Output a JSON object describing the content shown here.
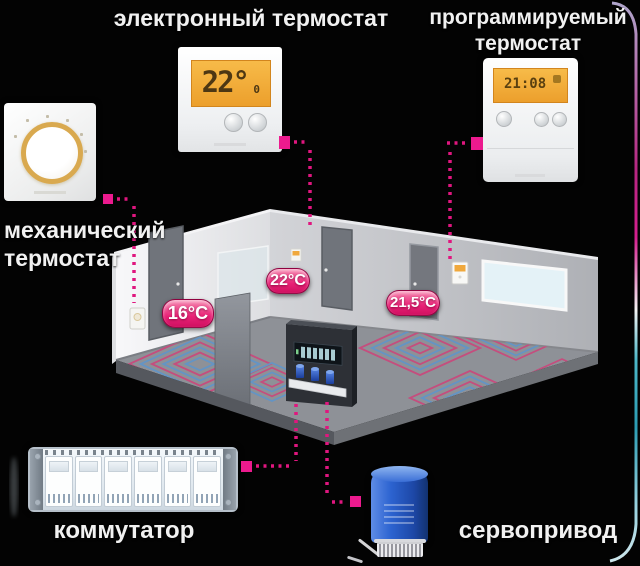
{
  "diagram_title": "Floor heating control system diagram",
  "labels": {
    "electronic_thermostat": "электронный термостат",
    "programmable_line1": "программируемый",
    "programmable_line2": "термостат",
    "mechanical_line1": "механический",
    "mechanical_line2": "термостат",
    "commutator": "коммутатор",
    "servo": "сервопривод"
  },
  "room": {
    "badges": [
      {
        "id": "left-room-temp",
        "label": "16°C"
      },
      {
        "id": "middle-room-temp",
        "label": "22°C"
      },
      {
        "id": "right-room-temp",
        "label": "21,5°C"
      }
    ]
  },
  "devices": {
    "electronic_thermostat": {
      "display_value": "22°",
      "display_sub": "0"
    },
    "programmable_thermostat": {
      "display_value": "21:08"
    }
  },
  "colors": {
    "background": "#030303",
    "label_text": "#f1f1f1",
    "accent_magenta": "#e8128a",
    "badge_gradient_top": "#f68bb2",
    "badge_gradient_bottom": "#cf1060",
    "lcd_orange": "#f0a83c",
    "coil_pink": "#c44e7e",
    "coil_blue": "#6494c4",
    "servo_blue": "#2c63d0",
    "wall_light": "#f5f5f7",
    "wall_gray": "#bfc1c6",
    "floor_gray": "#8e9197"
  }
}
